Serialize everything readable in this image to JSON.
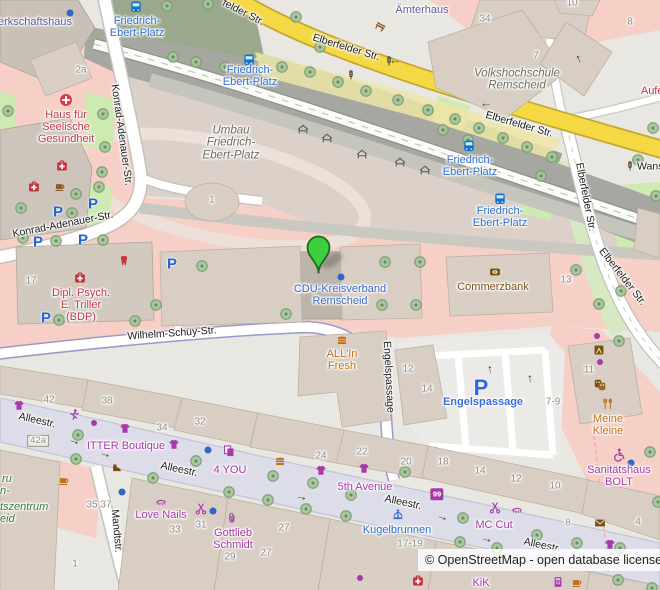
{
  "attribution": {
    "text": "© OpenStreetMap - open database license"
  },
  "map": {
    "marker": {
      "x": 318,
      "y": 273,
      "color": "#3ecf3e"
    },
    "colors": {
      "pink_retail": "#f6cfc7",
      "pedestrian": "#dcdde8",
      "yellow_road": "#f4d844",
      "building": "#d8cec4",
      "grass": "#cdeab0",
      "transit_blue": "#2e6fce",
      "shop_purple": "#a839a8",
      "amenity_brown": "#7a5014",
      "health_red": "#c0394b"
    },
    "labels": [
      {
        "n": "road-elberfelder-1",
        "t": "felder Str.",
        "x": 243,
        "y": 13,
        "r": 27,
        "c": "road"
      },
      {
        "n": "road-elberfelder-2",
        "t": "Elberfelder Str.",
        "x": 346,
        "y": 48,
        "r": 17,
        "c": "road"
      },
      {
        "n": "road-elberfelder-3",
        "t": "Elberfelder Str.",
        "x": 519,
        "y": 125,
        "r": 16,
        "c": "road"
      },
      {
        "n": "road-wans",
        "t": "Wans",
        "x": 637,
        "y": 167,
        "r": 0,
        "c": "road",
        "a": "left"
      },
      {
        "n": "road-elberfelder-4",
        "t": "Elberfelder Str.",
        "x": 585,
        "y": 197,
        "r": 79,
        "c": "road"
      },
      {
        "n": "road-elberfelder-5",
        "t": "Elberfelder Str.",
        "x": 622,
        "y": 277,
        "r": 52,
        "c": "road"
      },
      {
        "n": "road-konrad-adenauer-1",
        "t": "Konrad-Adenauer-Str.",
        "x": 121,
        "y": 135,
        "r": 82,
        "c": "road"
      },
      {
        "n": "road-konrad-adenauer-2",
        "t": "Konrad-Adenauer-Str.",
        "x": 63,
        "y": 225,
        "r": -11,
        "c": "road"
      },
      {
        "n": "road-wilhelm-schuy",
        "t": "Wilhelm-Schuy-Str.",
        "x": 172,
        "y": 334,
        "r": -4,
        "c": "road"
      },
      {
        "n": "road-engelspassage",
        "t": "Engelspassage",
        "x": 388,
        "y": 377,
        "r": 87,
        "c": "road"
      },
      {
        "n": "road-allee-1",
        "t": "Alleestr.",
        "x": 37,
        "y": 421,
        "r": 13,
        "c": "road"
      },
      {
        "n": "road-allee-2",
        "t": "Alleestr.",
        "x": 179,
        "y": 470,
        "r": 12,
        "c": "road"
      },
      {
        "n": "road-allee-3",
        "t": "Alleestr.",
        "x": 403,
        "y": 503,
        "r": 12,
        "c": "road"
      },
      {
        "n": "road-allee-4",
        "t": "Alleestr.",
        "x": 542,
        "y": 546,
        "r": 12,
        "c": "road"
      },
      {
        "n": "road-mandtstr",
        "t": "Mandtstr.",
        "x": 116,
        "y": 531,
        "r": 85,
        "c": "road"
      },
      {
        "n": "stop-friedrich-ebert-platz-1",
        "t": "Friedrich-\nEbert-Platz",
        "x": 137,
        "y": 28,
        "c": "transit"
      },
      {
        "n": "stop-friedrich-ebert-platz-2",
        "t": "Friedrich-\nEbert-Platz",
        "x": 250,
        "y": 77,
        "c": "transit"
      },
      {
        "n": "stop-friedrich-ebert-platz-3",
        "t": "Friedrich-\nEbert-Platz",
        "x": 470,
        "y": 167,
        "c": "transit"
      },
      {
        "n": "stop-friedrich-ebert-platz-4",
        "t": "Friedrich-\nEbert-Platz",
        "x": 500,
        "y": 218,
        "c": "transit"
      },
      {
        "n": "poi-kugelbrunnen",
        "t": "Kugelbrunnen",
        "x": 397,
        "y": 531,
        "c": "transit"
      },
      {
        "n": "poi-cdu-kreisverband",
        "t": "CDU-Kreisverband\nRemscheid",
        "x": 340,
        "y": 296,
        "c": "poiblue"
      },
      {
        "n": "parking-engelspassage",
        "t": "Engelspassage",
        "x": 483,
        "y": 403,
        "c": "parkinglbl"
      },
      {
        "n": "poi-haus-seelische-gesundheit",
        "t": "Haus für\nSeelische\nGesundheit",
        "x": 66,
        "y": 128,
        "c": "red"
      },
      {
        "n": "poi-triller",
        "t": "Dipl. Psych.\nE. Triller\n(BDP)",
        "x": 81,
        "y": 306,
        "c": "red"
      },
      {
        "n": "poi-aufer",
        "t": "Aufer",
        "x": 654,
        "y": 92,
        "c": "red"
      },
      {
        "n": "poi-commerzbank",
        "t": "Commerzbank",
        "x": 493,
        "y": 288,
        "c": "brown"
      },
      {
        "n": "poi-allin-fresh",
        "t": "ALL'In\nFresh",
        "x": 342,
        "y": 361,
        "c": "orange"
      },
      {
        "n": "poi-meine-kleine",
        "t": "Meine\nKleine",
        "x": 608,
        "y": 426,
        "c": "orange"
      },
      {
        "n": "shop-itter-boutique",
        "t": "ITTER Boutique",
        "x": 126,
        "y": 447,
        "c": "purple"
      },
      {
        "n": "shop-4you",
        "t": "4 YOU",
        "x": 230,
        "y": 471,
        "c": "purple"
      },
      {
        "n": "shop-5th-avenue",
        "t": "5th Avenue",
        "x": 365,
        "y": 488,
        "c": "purple"
      },
      {
        "n": "shop-love-nails",
        "t": "Love Nails",
        "x": 161,
        "y": 516,
        "c": "purple"
      },
      {
        "n": "shop-gottlieb-schmidt",
        "t": "Gottlieb\nSchmidt",
        "x": 233,
        "y": 540,
        "c": "purple"
      },
      {
        "n": "shop-mc-cut",
        "t": "MC Cut",
        "x": 494,
        "y": 526,
        "c": "purple"
      },
      {
        "n": "shop-sanitaetshaus-bolt",
        "t": "Sanitätshaus\nBOLT",
        "x": 619,
        "y": 477,
        "c": "purple"
      },
      {
        "n": "shop-kik",
        "t": "KiK",
        "x": 481,
        "y": 584,
        "c": "purple"
      },
      {
        "n": "poi-aemterhaus",
        "t": "Ämterhaus",
        "x": 422,
        "y": 11,
        "c": "civic"
      },
      {
        "n": "poi-gewerkschaftshaus",
        "t": "erkschaftshaus",
        "x": 35,
        "y": 23,
        "c": "civic"
      },
      {
        "n": "area-umbau",
        "t": "Umbau\nFriedrich-\nEbert-Platz",
        "x": 231,
        "y": 143,
        "c": "areait"
      },
      {
        "n": "area-volkshochschule",
        "t": "Volkshochschule\nRemscheid",
        "x": 517,
        "y": 80,
        "c": "areait"
      },
      {
        "n": "area-green-fragment-1",
        "t": "ru",
        "x": 2,
        "y": 480,
        "c": "greenit",
        "a": "left"
      },
      {
        "n": "area-green-fragment-2",
        "t": "n-",
        "x": 0,
        "y": 492,
        "c": "greenit",
        "a": "left"
      },
      {
        "n": "area-green-fragment-3",
        "t": "tszentrum",
        "x": 0,
        "y": 508,
        "c": "greenit",
        "a": "left"
      },
      {
        "n": "area-green-fragment-4",
        "t": "eid",
        "x": 0,
        "y": 520,
        "c": "greenit",
        "a": "left"
      },
      {
        "n": "hn-2a",
        "t": "2a",
        "x": 81,
        "y": 71,
        "c": "hn"
      },
      {
        "n": "hn-34-top",
        "t": "34",
        "x": 485,
        "y": 20,
        "c": "hn"
      },
      {
        "n": "hn-10-top",
        "t": "10",
        "x": 572,
        "y": 4,
        "c": "hn"
      },
      {
        "n": "hn-8-top",
        "t": "8",
        "x": 630,
        "y": 23,
        "c": "hn"
      },
      {
        "n": "hn-7",
        "t": "7",
        "x": 536,
        "y": 57,
        "c": "hn"
      },
      {
        "n": "hn-1-oval",
        "t": "1",
        "x": 212,
        "y": 201,
        "c": "hn"
      },
      {
        "n": "hn-17",
        "t": "17",
        "x": 31,
        "y": 282,
        "c": "hn"
      },
      {
        "n": "hn-13",
        "t": "13",
        "x": 566,
        "y": 281,
        "c": "hn"
      },
      {
        "n": "hn-12-engels",
        "t": "12",
        "x": 408,
        "y": 370,
        "c": "hn"
      },
      {
        "n": "hn-14-engels",
        "t": "14",
        "x": 427,
        "y": 390,
        "c": "hn"
      },
      {
        "n": "hn-11",
        "t": "11",
        "x": 589,
        "y": 371,
        "c": "hn"
      },
      {
        "n": "hn-7-9",
        "t": "7-9",
        "x": 553,
        "y": 403,
        "c": "hn"
      },
      {
        "n": "hn-42",
        "t": "42",
        "x": 49,
        "y": 401,
        "c": "hn"
      },
      {
        "n": "hn-38",
        "t": "38",
        "x": 107,
        "y": 402,
        "c": "hn"
      },
      {
        "n": "hn-34-allee",
        "t": "34",
        "x": 162,
        "y": 429,
        "c": "hn"
      },
      {
        "n": "hn-32",
        "t": "32",
        "x": 200,
        "y": 423,
        "c": "hn"
      },
      {
        "n": "hn-42a",
        "t": "42a",
        "x": 38,
        "y": 441,
        "c": "hn hnbox"
      },
      {
        "n": "hn-35-37",
        "t": "35,37",
        "x": 99,
        "y": 506,
        "c": "hn"
      },
      {
        "n": "hn-33",
        "t": "33",
        "x": 175,
        "y": 531,
        "c": "hn"
      },
      {
        "n": "hn-31",
        "t": "31",
        "x": 201,
        "y": 526,
        "c": "hn"
      },
      {
        "n": "hn-29",
        "t": "29",
        "x": 230,
        "y": 558,
        "c": "hn"
      },
      {
        "n": "hn-27-a",
        "t": "27",
        "x": 284,
        "y": 529,
        "c": "hn"
      },
      {
        "n": "hn-27-b",
        "t": "27",
        "x": 266,
        "y": 554,
        "c": "hn"
      },
      {
        "n": "hn-1-mandt",
        "t": "1",
        "x": 75,
        "y": 565,
        "c": "hn"
      },
      {
        "n": "hn-24",
        "t": "24",
        "x": 321,
        "y": 457,
        "c": "hn"
      },
      {
        "n": "hn-22",
        "t": "22",
        "x": 362,
        "y": 453,
        "c": "hn"
      },
      {
        "n": "hn-20",
        "t": "20",
        "x": 406,
        "y": 463,
        "c": "hn"
      },
      {
        "n": "hn-18",
        "t": "18",
        "x": 443,
        "y": 463,
        "c": "hn"
      },
      {
        "n": "hn-14-allee",
        "t": "14",
        "x": 480,
        "y": 472,
        "c": "hn"
      },
      {
        "n": "hn-12-allee",
        "t": "12",
        "x": 516,
        "y": 480,
        "c": "hn"
      },
      {
        "n": "hn-10-allee",
        "t": "10",
        "x": 555,
        "y": 487,
        "c": "hn"
      },
      {
        "n": "hn-8-allee",
        "t": "8",
        "x": 568,
        "y": 524,
        "c": "hn"
      },
      {
        "n": "hn-4",
        "t": "4",
        "x": 638,
        "y": 523,
        "c": "hn"
      },
      {
        "n": "hn-17-19",
        "t": "17-19",
        "x": 410,
        "y": 545,
        "c": "hn"
      }
    ],
    "icons": [
      {
        "t": "bus",
        "x": 136,
        "y": 7
      },
      {
        "t": "bus",
        "x": 249,
        "y": 60
      },
      {
        "t": "bus",
        "x": 469,
        "y": 146
      },
      {
        "t": "bus",
        "x": 500,
        "y": 199
      },
      {
        "t": "P",
        "tx": "P",
        "x": 58,
        "y": 212
      },
      {
        "t": "P",
        "tx": "P",
        "x": 93,
        "y": 204
      },
      {
        "t": "P",
        "tx": "P",
        "x": 38,
        "y": 242
      },
      {
        "t": "P",
        "tx": "P",
        "x": 83,
        "y": 240
      },
      {
        "t": "P",
        "tx": "P",
        "x": 172,
        "y": 264
      },
      {
        "t": "P",
        "tx": "P",
        "x": 46,
        "y": 318
      },
      {
        "t": "Pbig",
        "tx": "P",
        "x": 481,
        "y": 388
      },
      {
        "t": "signal",
        "x": 351,
        "y": 75
      },
      {
        "t": "signal",
        "x": 389,
        "y": 61
      },
      {
        "t": "signal",
        "x": 630,
        "y": 166
      },
      {
        "t": "arrow",
        "tx": "→",
        "x": 395,
        "y": 64,
        "r": 180
      },
      {
        "t": "arrow",
        "tx": "→",
        "x": 486,
        "y": 107,
        "r": 180
      },
      {
        "t": "arrow",
        "tx": "→",
        "x": 577,
        "y": 60,
        "r": -115
      },
      {
        "t": "arrow",
        "tx": "→",
        "x": 75,
        "y": 440,
        "r": 20
      },
      {
        "t": "arrow",
        "tx": "→",
        "x": 106,
        "y": 453,
        "r": 18
      },
      {
        "t": "arrow",
        "tx": "→",
        "x": 302,
        "y": 496,
        "r": 12
      },
      {
        "t": "arrow",
        "tx": "→",
        "x": 443,
        "y": 516,
        "r": 20
      },
      {
        "t": "arrow",
        "tx": "→",
        "x": 487,
        "y": 538,
        "r": 14
      },
      {
        "t": "arrow",
        "tx": "→",
        "x": 488,
        "y": 370,
        "r": -95
      },
      {
        "t": "arrow",
        "tx": "→",
        "x": 528,
        "y": 379,
        "r": -95
      },
      {
        "t": "crosscircle",
        "x": 66,
        "y": 100
      },
      {
        "t": "kit",
        "x": 62,
        "y": 166
      },
      {
        "t": "kit",
        "x": 34,
        "y": 187
      },
      {
        "t": "kit",
        "x": 80,
        "y": 278
      },
      {
        "t": "kit",
        "x": 418,
        "y": 581
      },
      {
        "t": "tooth",
        "x": 124,
        "y": 261
      },
      {
        "t": "cupbr",
        "x": 60,
        "y": 187
      },
      {
        "t": "cupor",
        "x": 64,
        "y": 481
      },
      {
        "t": "cupor",
        "x": 577,
        "y": 583
      },
      {
        "t": "bank",
        "x": 495,
        "y": 272
      },
      {
        "t": "burger",
        "x": 342,
        "y": 340
      },
      {
        "t": "burger",
        "x": 280,
        "y": 461
      },
      {
        "t": "tshirt",
        "x": 19,
        "y": 406
      },
      {
        "t": "tshirt",
        "x": 125,
        "y": 429
      },
      {
        "t": "tshirt",
        "x": 174,
        "y": 445
      },
      {
        "t": "tshirt",
        "x": 321,
        "y": 471
      },
      {
        "t": "tshirt",
        "x": 364,
        "y": 469
      },
      {
        "t": "tshirt",
        "x": 610,
        "y": 545
      },
      {
        "t": "runner",
        "x": 74,
        "y": 415
      },
      {
        "t": "shoe",
        "x": 117,
        "y": 468
      },
      {
        "t": "eyelash",
        "x": 161,
        "y": 502
      },
      {
        "t": "eyelash",
        "x": 517,
        "y": 510
      },
      {
        "t": "scissors",
        "x": 201,
        "y": 509
      },
      {
        "t": "scissors",
        "x": 495,
        "y": 508
      },
      {
        "t": "paperclip",
        "x": 232,
        "y": 518
      },
      {
        "t": "copyshop",
        "x": 229,
        "y": 451
      },
      {
        "t": "wheelchair",
        "x": 619,
        "y": 455
      },
      {
        "t": "forkknife",
        "x": 608,
        "y": 404
      },
      {
        "t": "masks",
        "x": 600,
        "y": 385
      },
      {
        "t": "miscbrown",
        "x": 599,
        "y": 350
      },
      {
        "t": "envelope",
        "x": 600,
        "y": 523
      },
      {
        "t": "fountain",
        "x": 398,
        "y": 515
      },
      {
        "t": "badge",
        "tx": "99",
        "x": 437,
        "y": 494
      },
      {
        "t": "bench",
        "x": 380,
        "y": 27
      },
      {
        "t": "till",
        "x": 558,
        "y": 582
      },
      {
        "t": "shelter",
        "x": 303,
        "y": 130
      },
      {
        "t": "shelter",
        "x": 327,
        "y": 139
      },
      {
        "t": "shelter",
        "x": 362,
        "y": 155
      },
      {
        "t": "shelter",
        "x": 400,
        "y": 163
      },
      {
        "t": "shelter",
        "x": 425,
        "y": 171
      },
      {
        "t": "dotblue",
        "x": 70,
        "y": 13
      },
      {
        "t": "dotblue",
        "x": 341,
        "y": 277
      },
      {
        "t": "dotblue",
        "x": 208,
        "y": 450
      },
      {
        "t": "dotblue",
        "x": 122,
        "y": 492
      },
      {
        "t": "dotblue",
        "x": 213,
        "y": 511
      },
      {
        "t": "dotblue",
        "x": 631,
        "y": 463
      },
      {
        "t": "dotpurple",
        "x": 94,
        "y": 423
      },
      {
        "t": "dotpurple",
        "x": 597,
        "y": 336
      },
      {
        "t": "dotpurple",
        "x": 600,
        "y": 362
      },
      {
        "t": "dotpurple",
        "x": 360,
        "y": 578
      }
    ],
    "trees": [
      [
        167,
        6
      ],
      [
        208,
        4
      ],
      [
        296,
        17
      ],
      [
        320,
        47
      ],
      [
        8,
        111
      ],
      [
        103,
        114
      ],
      [
        105,
        147
      ],
      [
        102,
        172
      ],
      [
        99,
        187
      ],
      [
        21,
        208
      ],
      [
        76,
        194
      ],
      [
        72,
        213
      ],
      [
        23,
        238
      ],
      [
        56,
        241
      ],
      [
        103,
        240
      ],
      [
        225,
        67
      ],
      [
        282,
        67
      ],
      [
        310,
        72
      ],
      [
        338,
        82
      ],
      [
        366,
        91
      ],
      [
        398,
        100
      ],
      [
        428,
        110
      ],
      [
        455,
        119
      ],
      [
        479,
        128
      ],
      [
        503,
        138
      ],
      [
        527,
        147
      ],
      [
        552,
        157
      ],
      [
        443,
        130
      ],
      [
        468,
        140
      ],
      [
        173,
        57
      ],
      [
        196,
        62
      ],
      [
        576,
        270
      ],
      [
        621,
        291
      ],
      [
        599,
        304
      ],
      [
        619,
        341
      ],
      [
        541,
        176
      ],
      [
        638,
        160
      ],
      [
        653,
        128
      ],
      [
        656,
        196
      ],
      [
        385,
        262
      ],
      [
        420,
        262
      ],
      [
        382,
        305
      ],
      [
        416,
        305
      ],
      [
        286,
        314
      ],
      [
        202,
        266
      ],
      [
        156,
        305
      ],
      [
        59,
        320
      ],
      [
        135,
        321
      ],
      [
        78,
        435
      ],
      [
        76,
        459
      ],
      [
        153,
        478
      ],
      [
        196,
        461
      ],
      [
        273,
        476
      ],
      [
        229,
        492
      ],
      [
        268,
        500
      ],
      [
        313,
        483
      ],
      [
        306,
        509
      ],
      [
        351,
        495
      ],
      [
        346,
        516
      ],
      [
        463,
        518
      ],
      [
        460,
        542
      ],
      [
        497,
        548
      ],
      [
        537,
        535
      ],
      [
        577,
        543
      ],
      [
        620,
        548
      ],
      [
        650,
        452
      ],
      [
        658,
        502
      ],
      [
        618,
        580
      ],
      [
        652,
        588
      ],
      [
        405,
        472
      ]
    ]
  }
}
